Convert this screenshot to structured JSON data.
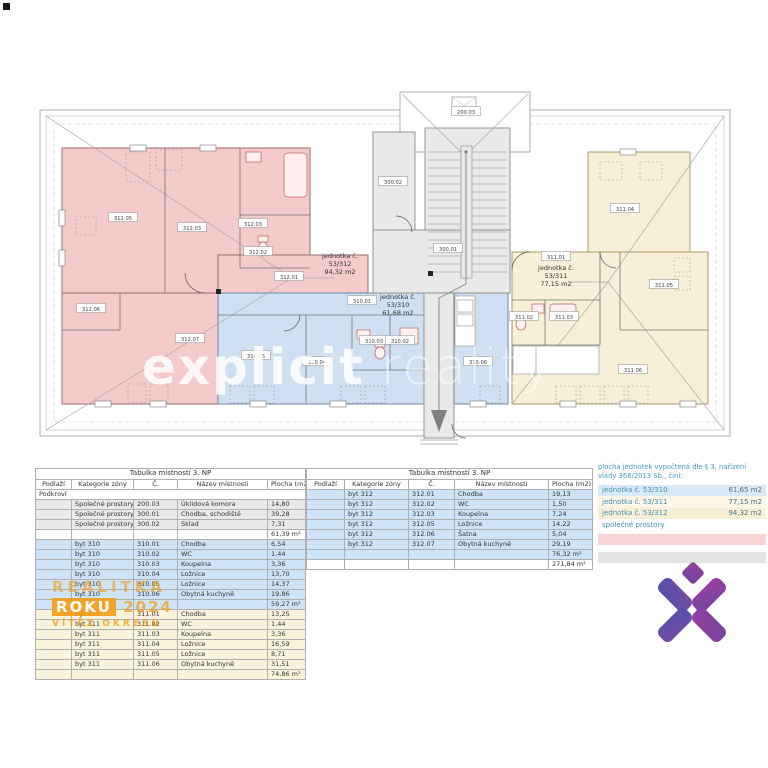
{
  "colors": {
    "zone_pink": "#f5caca",
    "zone_blue": "#cfe0f3",
    "zone_cream": "#f7efd7",
    "zone_gray": "#e9e9e9",
    "table_blue": "#cfe3f7",
    "table_cream": "#faf3dc",
    "table_gray": "#e9e9e9",
    "legend_teal": "#45a0c6",
    "watermark_orange": "#f39c12",
    "logo_purple_blue": "#4f4fa8",
    "logo_purple_magenta": "#9a3f9e"
  },
  "plan": {
    "units": [
      {
        "name": "jednotka č.",
        "num": "53/312",
        "area": "94,32 m2"
      },
      {
        "name": "jednotka č.",
        "num": "53/310",
        "area": "61,68 m2"
      },
      {
        "name": "jednotka č.",
        "num": "53/311",
        "area": "77,15 m2"
      }
    ],
    "tags": [
      {
        "label": "312.05"
      },
      {
        "label": "312.03"
      },
      {
        "label": "312.03"
      },
      {
        "label": "312.02"
      },
      {
        "label": "312.01"
      },
      {
        "label": "312.06"
      },
      {
        "label": "312.07"
      },
      {
        "label": "310.01"
      },
      {
        "label": "310.05"
      },
      {
        "label": "310.04"
      },
      {
        "label": "310.03"
      },
      {
        "label": "310.02"
      },
      {
        "label": "310.06"
      },
      {
        "label": "311.04"
      },
      {
        "label": "311.01"
      },
      {
        "label": "311.05"
      },
      {
        "label": "311.02"
      },
      {
        "label": "311.03"
      },
      {
        "label": "311.06"
      },
      {
        "label": "300.02"
      },
      {
        "label": "300.01"
      },
      {
        "label": "200.03"
      }
    ]
  },
  "watermarks": {
    "plan_word1": "explicit",
    "plan_word2": "reality",
    "badge_line1": "REALITKA",
    "badge_roku": "ROKU",
    "badge_year": "2024",
    "badge_line3": "VÍTĚZ OKRESU"
  },
  "tables": {
    "left": {
      "title": "Tabulka místností 3. NP",
      "columns": [
        "Podlaží",
        "Kategorie zóny",
        "Č.",
        "Název místnosti",
        "Plocha (m2)"
      ],
      "section": "Podkroví",
      "groups": [
        {
          "bg": "#e9e9e9",
          "subtotal_bg": "#ffffff",
          "subtotal": "61,39 m²",
          "rows": [
            [
              "Společné prostory",
              "200.03",
              "Úklidová komora",
              "14,80"
            ],
            [
              "Společné prostory",
              "300.01",
              "Chodba, schodiště",
              "39,28"
            ],
            [
              "Společné prostory",
              "300.02",
              "Sklad",
              "7,31"
            ]
          ]
        },
        {
          "bg": "#cfe3f7",
          "subtotal_bg": "#cfe3f7",
          "subtotal": "59,27 m²",
          "rows": [
            [
              "byt 310",
              "310.01",
              "Chodba",
              "6,54"
            ],
            [
              "byt 310",
              "310.02",
              "WC",
              "1,44"
            ],
            [
              "byt 310",
              "310.03",
              "Koupelna",
              "3,36"
            ],
            [
              "byt 310",
              "310.04",
              "Ložnice",
              "13,70"
            ],
            [
              "byt 310",
              "310.05",
              "Ložnice",
              "14,37"
            ],
            [
              "byt 310",
              "310.06",
              "Obytná kuchyně",
              "19,86"
            ]
          ]
        },
        {
          "bg": "#faf3dc",
          "subtotal_bg": "#faf3dc",
          "subtotal": "74,86 m²",
          "rows": [
            [
              "byt 311",
              "311.01",
              "Chodba",
              "13,25"
            ],
            [
              "byt 311",
              "311.02",
              "WC",
              "1,44"
            ],
            [
              "byt 311",
              "311.03",
              "Koupelna",
              "3,36"
            ],
            [
              "byt 311",
              "311.04",
              "Ložnice",
              "16,59"
            ],
            [
              "byt 311",
              "311.05",
              "Ložnice",
              "8,71"
            ],
            [
              "byt 311",
              "311.06",
              "Obytná kuchyně",
              "31,51"
            ]
          ]
        }
      ]
    },
    "right": {
      "title": "Tabulka místností 3. NP",
      "columns": [
        "Podlaží",
        "Kategorie zóny",
        "Č.",
        "Název místnosti",
        "Plocha (m2)"
      ],
      "groups": [
        {
          "bg": "#cfe3f7",
          "subtotal_bg": "#cfe3f7",
          "subtotal": "76,32 m²",
          "rows": [
            [
              "byt 312",
              "312.01",
              "Chodba",
              "19,13"
            ],
            [
              "byt 312",
              "312.02",
              "WC",
              "1,50"
            ],
            [
              "byt 312",
              "312.03",
              "Koupelna",
              "7,24"
            ],
            [
              "byt 312",
              "312.05",
              "Ložnice",
              "14,22"
            ],
            [
              "byt 312",
              "312.06",
              "Šatna",
              "5,04"
            ],
            [
              "byt 312",
              "312.07",
              "Obytná kuchyně",
              "29,19"
            ]
          ]
        }
      ],
      "total": "271,84 m²"
    }
  },
  "legend": {
    "header_line1": "plocha jednotek vypočtená dle § 3, nařízení",
    "header_line2": "vlády 366/2013 Sb., činí:",
    "rows": [
      {
        "label": "jednotka č. 53/310",
        "value": "61,65  m2",
        "bg": "#d9e9f7"
      },
      {
        "label": "jednotka č. 53/311",
        "value": "77,15  m2",
        "bg": "#fbf6e6"
      },
      {
        "label": "jednotka č. 53/312",
        "value": "94,32 m2",
        "bg": "#f7efd5"
      },
      {
        "label": "společné prostory",
        "value": "",
        "bg": "#ffffff"
      }
    ],
    "bands": [
      {
        "bg": "#f8d3d3"
      },
      {
        "bg": "#e4e4e4"
      }
    ]
  }
}
